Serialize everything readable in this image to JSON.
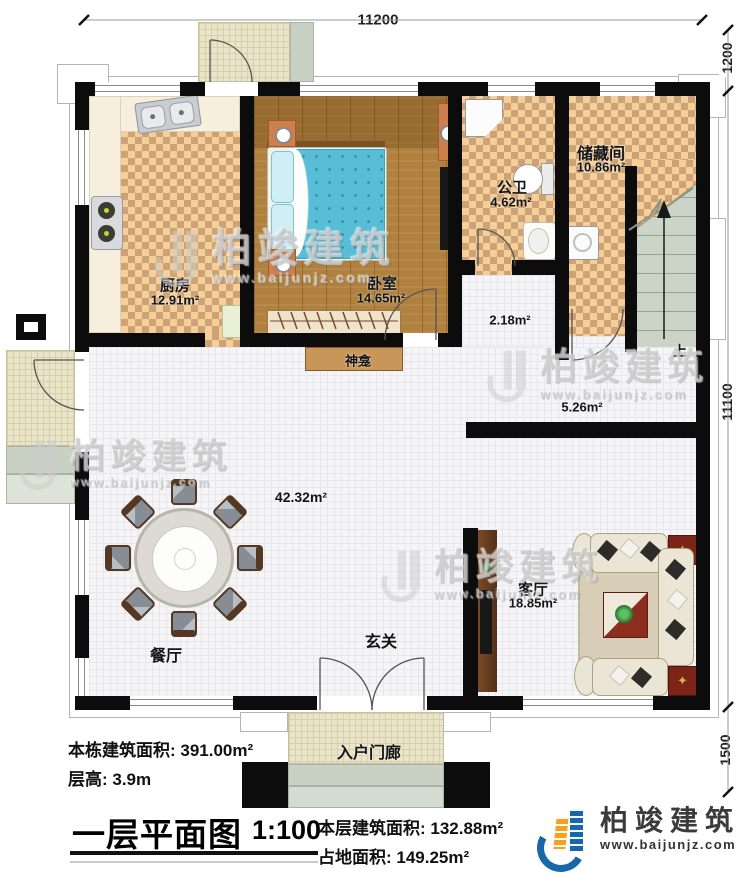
{
  "dimensions": {
    "top": "11200",
    "right_top": "1200",
    "right_middle": "11100",
    "right_bottom": "1500"
  },
  "rooms": {
    "kitchen": {
      "name": "厨房",
      "area": "12.91m²"
    },
    "bedroom": {
      "name": "卧室",
      "area": "14.65m²"
    },
    "bathroom": {
      "name": "公卫",
      "area": "4.62m²"
    },
    "storage": {
      "name": "储藏间",
      "area": "10.86m²"
    },
    "hall": {
      "area": "2.18m²"
    },
    "corridor": {
      "area": "5.26m²"
    },
    "dining": {
      "name": "餐厅",
      "area": "42.32m²"
    },
    "entry": {
      "name": "玄关"
    },
    "living": {
      "name": "客厅",
      "area": "18.85m²"
    },
    "shrine": {
      "name": "神龛"
    },
    "entry_porch": {
      "name": "入户门廊"
    },
    "stairs": {
      "direction": "上"
    }
  },
  "title_block": {
    "building_total": "本栋建筑面积: 391.00m²",
    "floor_height": "层高: 3.9m",
    "drawing_title": "一层平面图",
    "scale": "1:100",
    "floor_area": "本层建筑面积: 132.88m²",
    "footprint_area": "占地面积: 149.25m²"
  },
  "brand": {
    "name": "柏竣建筑",
    "url": "www.baijunjz.com"
  },
  "watermark": {
    "name": "柏竣建筑",
    "url": "www.baijunjz.com"
  }
}
